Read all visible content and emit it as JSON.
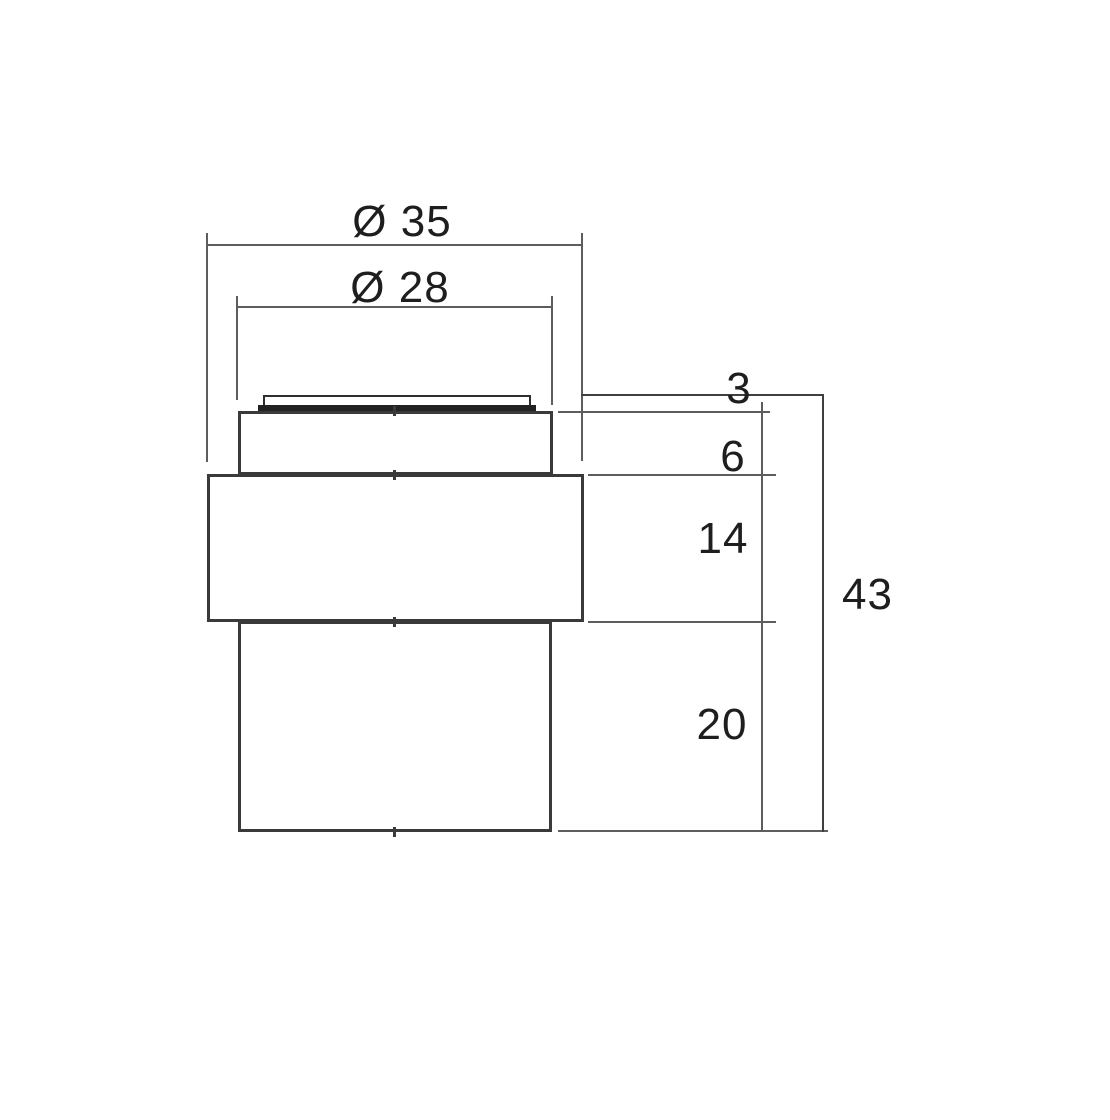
{
  "labels": {
    "outer_diameter": "Ø 35",
    "inner_diameter": "Ø 28",
    "cap_height": "3",
    "neck_height": "6",
    "flange_height": "14",
    "base_height": "20",
    "total_height": "43"
  },
  "dimensions_mm": {
    "outer_diameter": 35,
    "inner_diameter": 28,
    "cap_height": 3,
    "neck_height": 6,
    "flange_height": 14,
    "base_height": 20,
    "total_height": 43
  },
  "colors": {
    "background": "#ffffff",
    "body_line": "#3a3a3a",
    "dimension_line": "#5d5d5d",
    "text": "#1e1e1e"
  }
}
